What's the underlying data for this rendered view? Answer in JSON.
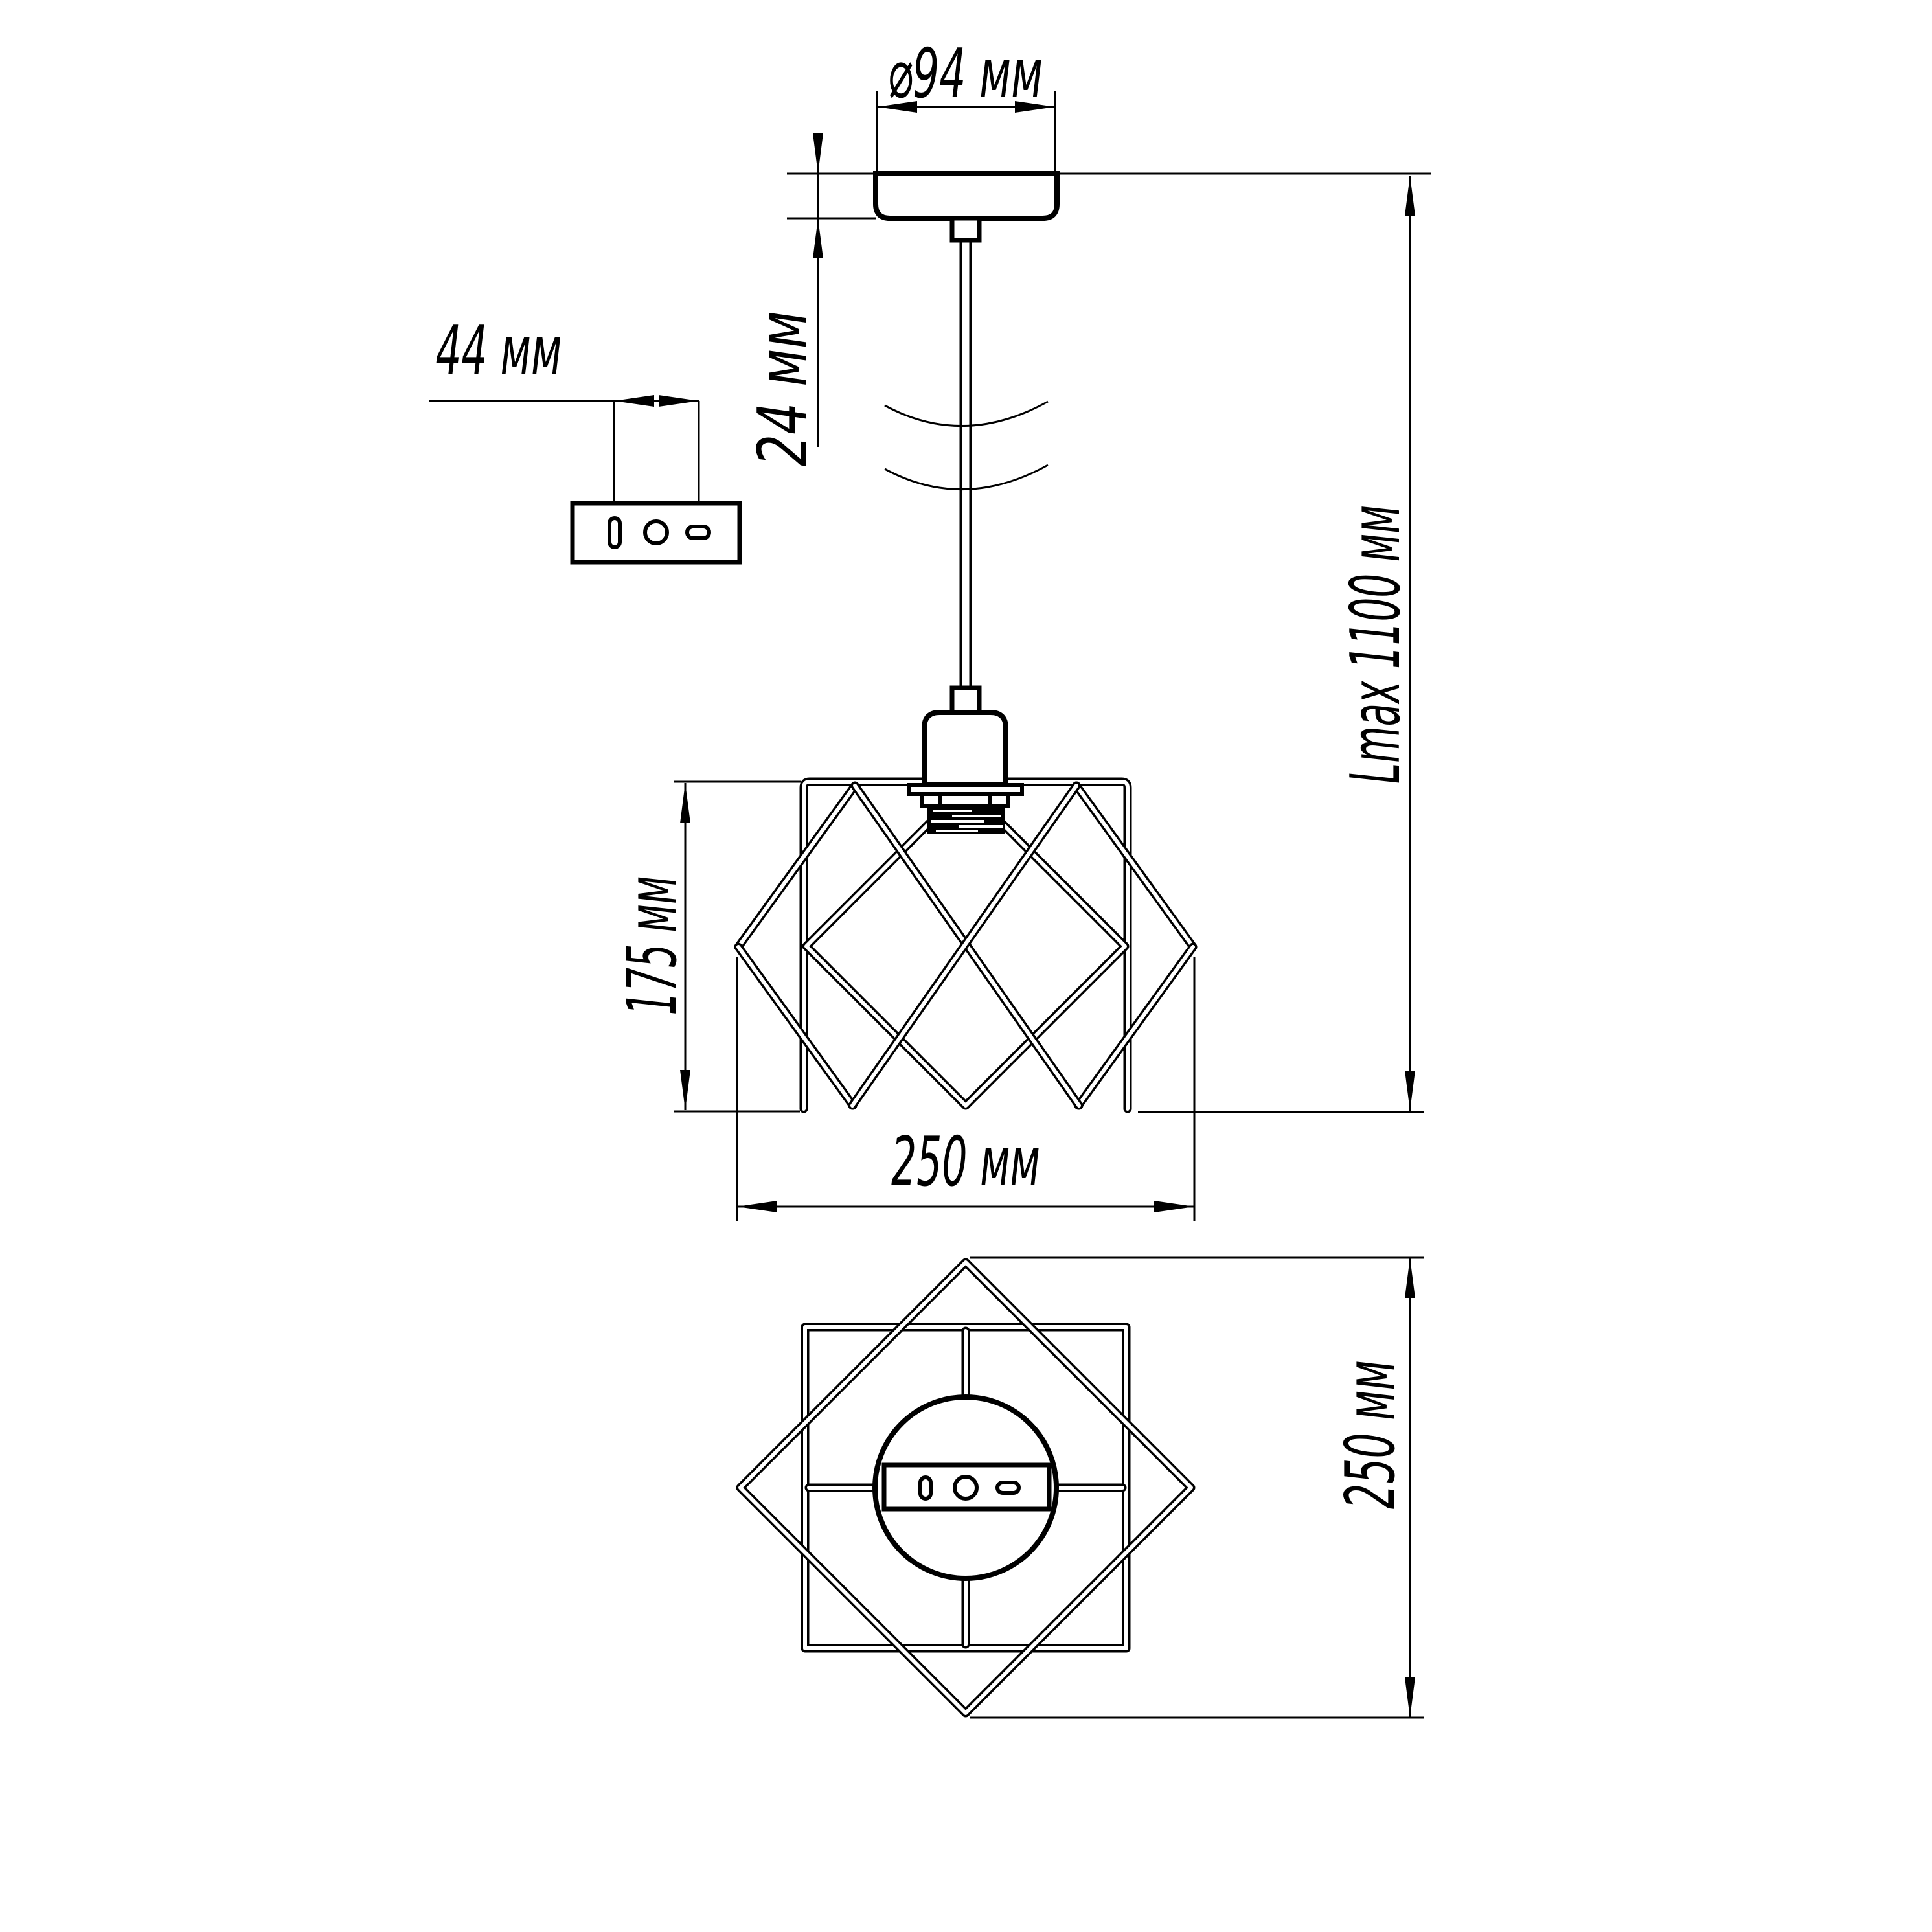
{
  "drawing": {
    "kind": "pendant lamp dimensional drawing",
    "background_color": "#ffffff",
    "line_color": "#000000",
    "dims": {
      "canopy_diameter": "⌀94 мм",
      "canopy_height": "24 мм",
      "bracket_hole_spacing": "44 мм",
      "max_suspension_length": "Lmax 1100 мм",
      "shade_height": "175 мм",
      "shade_width": "250 мм",
      "plan_width": "250 мм"
    }
  }
}
